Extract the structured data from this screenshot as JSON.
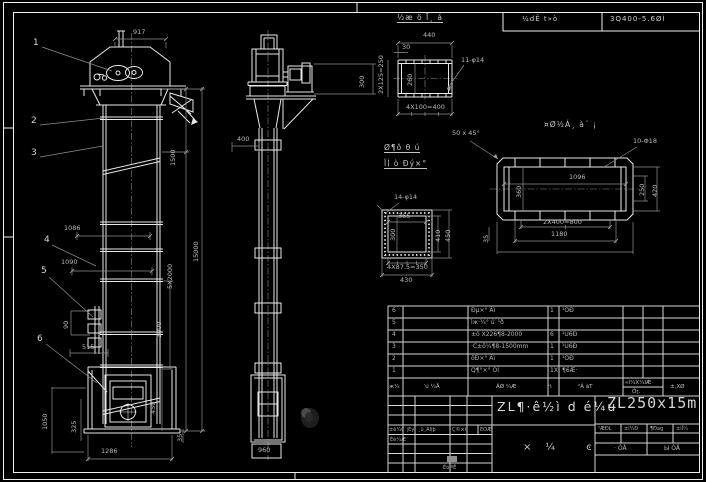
{
  "header": {
    "left_cell": "¼dÊ t»ò",
    "right_cell": "3Q400-5.6ØÌ"
  },
  "balloons": {
    "b1": "1",
    "b2": "2",
    "b3": "3",
    "b4": "4",
    "b5": "5",
    "b6": "6"
  },
  "dims": {
    "d917": "917",
    "d1500": "1500",
    "d15000": "15000",
    "d5x2000": "5X2000",
    "d3000": "3000",
    "d450": "450",
    "d1086": "1086",
    "d1090": "1090",
    "d90": "90",
    "d515": "515",
    "d1050": "1050",
    "d325": "325",
    "d1286": "1286",
    "d35a": "35",
    "d400": "400",
    "d300": "300",
    "d960": "960"
  },
  "detail_top": {
    "title": "½æ ö Ī¸ á",
    "d440": "440",
    "d30": "30",
    "d2x125": "2X125=250",
    "d260": "260",
    "holes": "11-φ14",
    "d4x100": "4X100=400"
  },
  "detail_channel": {
    "title": "¤Ø½Á¸ à´ ¡",
    "chamfer": "50 x 45°",
    "holes": "10-Φ18",
    "d1096": "1096",
    "d360": "360",
    "d250": "250",
    "d420": "420",
    "d2x400": "2X400=800",
    "d1180": "1180",
    "d35": "35"
  },
  "detail_square": {
    "title1": "Ø¶ô θ ú",
    "title2": "ÏÌ ò Ðý×°",
    "holes": "14-φ14",
    "d365": "365",
    "d300": "300",
    "d410": "410",
    "d450": "450",
    "d4x875": "4X87.5=350",
    "d430": "430"
  },
  "parts_table": {
    "rows": [
      {
        "no": "6",
        "name": "Ðµ×° Áì",
        "qty": "1",
        "mat": "¹ÖÐ"
      },
      {
        "no": "5",
        "name": "ìж·¼° ú′ ¹ð",
        "qty": "",
        "mat": ""
      },
      {
        "no": "4",
        "name": "±ô X226¶8-2000",
        "qty": "6",
        "mat": "¹Ü6Ð"
      },
      {
        "no": "3",
        "name": "·C±ô¼¶8-1500mm",
        "qty": "1",
        "mat": "¹Ü6Ð"
      },
      {
        "no": "2",
        "name": "ôÐ×° Áì",
        "qty": "1",
        "mat": "¹ÖÐ"
      },
      {
        "no": "1",
        "name": "Q¶°×° ÓÌ",
        "qty": "1X",
        "mat": "¶6Æ·"
      }
    ],
    "header": {
      "no": "ж¼",
      "code": "′ú ¼Å",
      "name": "ÃØ ¼Æ",
      "qty": "ʶì",
      "mat": "²Á àT",
      "weight_top": "«Ì¼X¼ÌÆ",
      "weight_sub": "Óɼ.",
      "note": "±,XØ"
    }
  },
  "title_block": {
    "drawing_name": "ZL¶·ê½ì d é¼ú",
    "model": "ZL250x15m",
    "info_cells": [
      "¹ÆÐL",
      "±ì¼Ð",
      "¶Ðag",
      "±ìÎ¼"
    ],
    "sheet_left": "· ÓÅ",
    "sheet_right": "Ы ÓÅ",
    "rev_row": [
      "±ê¼Ç",
      "´¦Êý",
      "¸ü¸ÄÎļþ",
      "Ç©×Ö",
      "ÈÕÆÚ"
    ],
    "designer": "Éè¼Æ",
    "checker": "Éó ºË",
    "type_label": "×¼  ͼ"
  }
}
